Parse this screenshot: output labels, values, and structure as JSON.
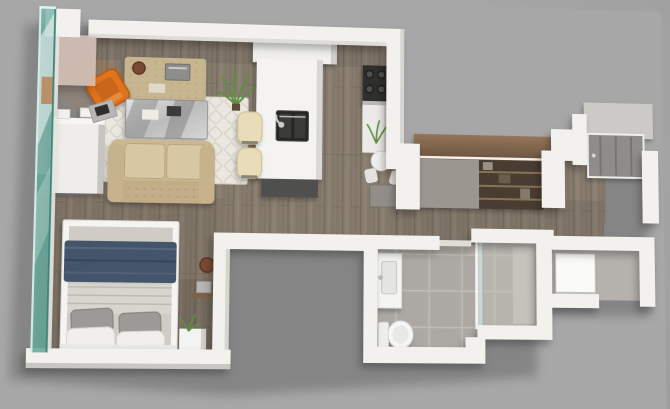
{
  "meta": {
    "title": "3D Isometric Studio Apartment Floor Plan Render",
    "view": "top-down perspective render",
    "canvas": {
      "width": 670,
      "height": 409
    }
  },
  "colors": {
    "background": "#a7a7a7",
    "wall": "#f2f1ee",
    "wall_shade": "#d7d5d1",
    "wall_warm_face": "#d9c4b8",
    "floor_wood": "#867b6d",
    "floor_wood_dark": "#6e655a",
    "tile": "#aeaba5",
    "tile_light": "#bab7b1",
    "concrete": "#b5b2ae",
    "glass": "#7ab5aa",
    "glass_edge": "#3f8579",
    "sofa": "#cbb893",
    "cushion": "#d8c7a3",
    "stool": "#e9ddb9",
    "rug": "#eae7e0",
    "rug_motif": "#d9d4c8",
    "accent_orange": "#e0731d",
    "accent_orange_dark": "#b55a12",
    "duvet_navy": "#43546b",
    "sheet_gray": "#cfccc6",
    "pillow_gray": "#9b9a96",
    "pillow_white": "#f0efec",
    "closet_wood": "#7d6248",
    "appliance": "#2d2d2b",
    "metal": "#c9c9c9",
    "plant": "#5f8f45",
    "entry_door": "#8f8d89",
    "washer": "#fafaf8"
  },
  "rooms": [
    {
      "id": "living",
      "name": "Living Room"
    },
    {
      "id": "kitchen",
      "name": "Kitchen"
    },
    {
      "id": "hallway",
      "name": "Hallway"
    },
    {
      "id": "bedroom",
      "name": "Bedroom"
    },
    {
      "id": "bathroom",
      "name": "Bathroom"
    },
    {
      "id": "laundry",
      "name": "Laundry Closet"
    },
    {
      "id": "entry",
      "name": "Entry"
    }
  ],
  "furniture": {
    "glass_wall": "Floor-to-ceiling glass wall",
    "sofa": "Tufted sofa",
    "coffee_table": "Mirrored coffee table",
    "rug": "Trellis area rug",
    "console": "Console table with books and bowl",
    "accent_chair": "Orange accent chair",
    "plant": "Potted plant",
    "dresser": "White media cabinet",
    "desk": "Desk with laptop",
    "island": "Kitchen island with sink",
    "stools": "Upholstered bar stools",
    "fridge": "Fridge and tall cabinets",
    "range": "Range cooktop",
    "counter": "Kitchen counter with plant",
    "cafe_table": "Cafe table and chairs",
    "wardrobe": "Wood-topped wardrobe closet",
    "bed": "Bed with navy duvet",
    "duvet": "Navy duvet",
    "pillows": "Pillows",
    "nightstand": "Nightstand with plant",
    "shelf": "Floating wall shelf",
    "floor_bowl": "Decorative bowl",
    "vanity": "Bathroom vanity sink",
    "toilet": "Toilet",
    "shower": "Walk-in shower",
    "glass_panel": "Shower glass panel",
    "washer": "Washer/dryer unit",
    "door": "Entry door"
  }
}
